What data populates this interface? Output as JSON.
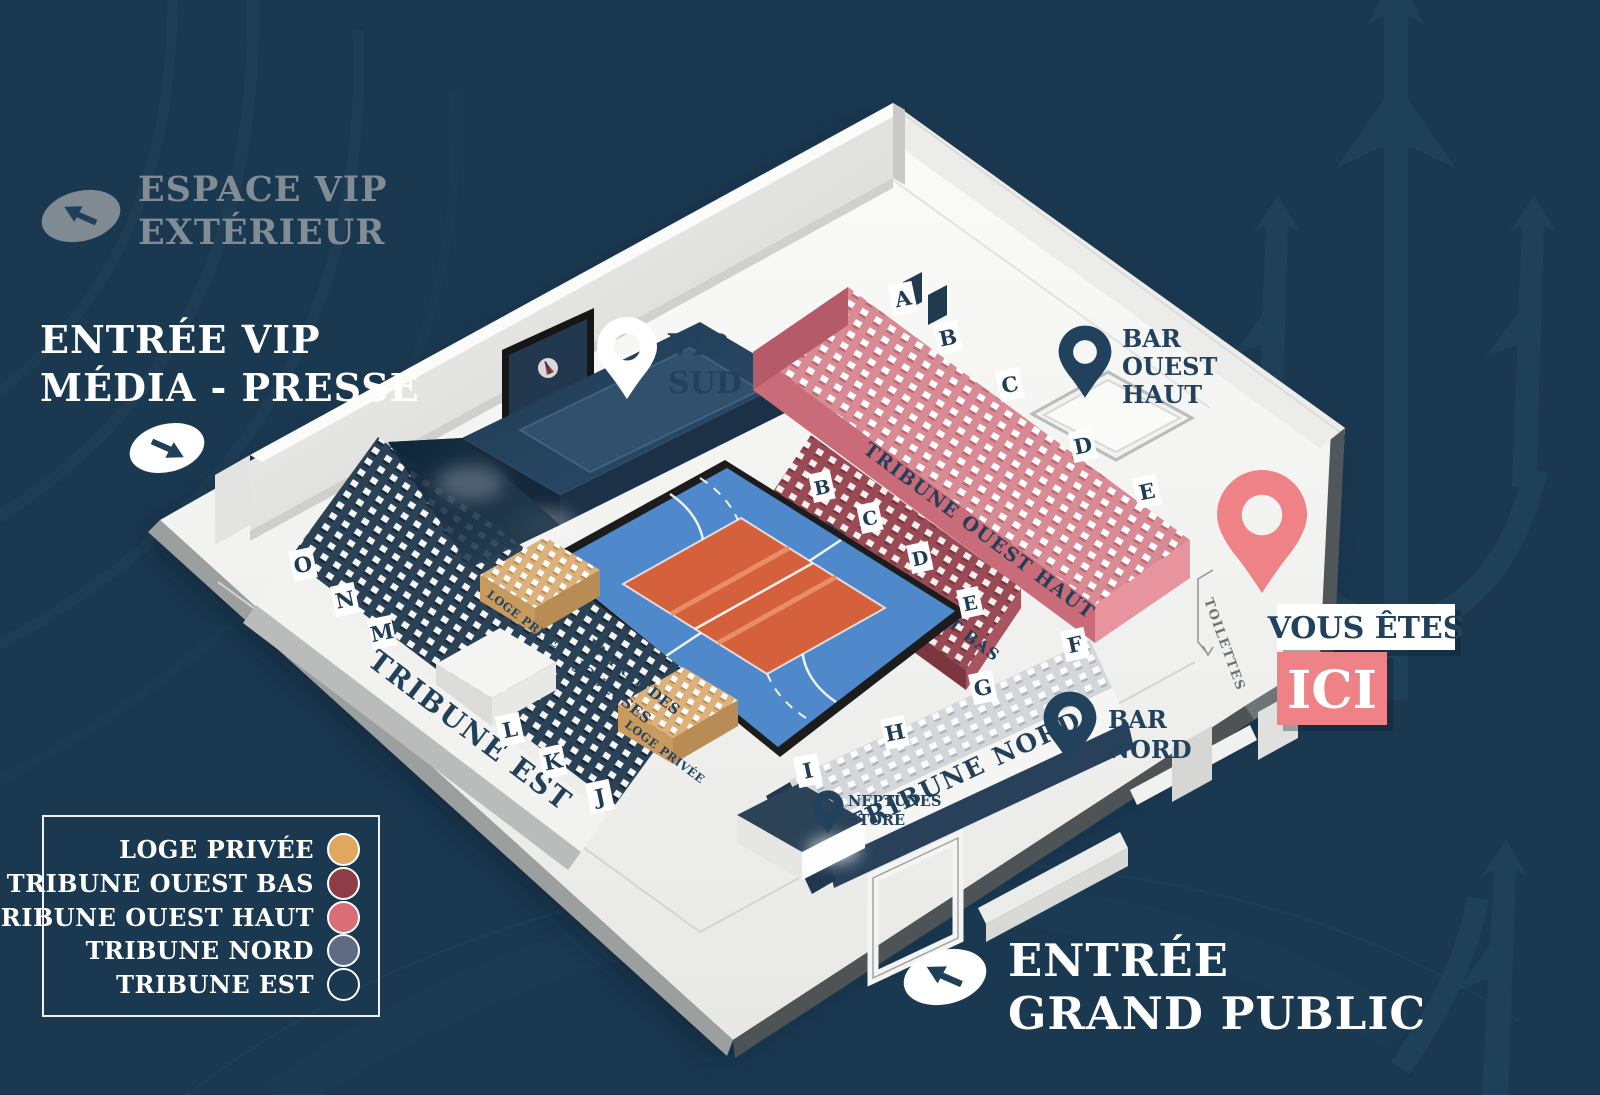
{
  "colors": {
    "background": "#1a3850",
    "accent_pink": "#ef8286",
    "navy": "#22415c",
    "loge_privee": "#e0a75e",
    "tribune_ouest_bas": "#8e3d47",
    "tribune_ouest_haut": "#d96d78",
    "tribune_nord": "#5f6b83",
    "tribune_est": "transparent"
  },
  "outside": {
    "espace_vip": {
      "line1": "ESPACE VIP",
      "line2": "EXTÉRIEUR",
      "arrow": "up-left"
    },
    "entree_vip": {
      "line1": "ENTRÉE VIP",
      "line2": "MÉDIA - PRESSE",
      "arrow": "down-right"
    },
    "entree_grand_public": {
      "line1": "ENTRÉE",
      "line2": "GRAND PUBLIC",
      "arrow": "up-left"
    }
  },
  "pins": {
    "vip_sud": {
      "line1": "VIP",
      "line2": "SUD"
    },
    "bar_ouest_haut": {
      "line1": "BAR",
      "line2": "OUEST",
      "line3": "HAUT"
    },
    "bar_nord": {
      "line1": "BAR",
      "line2": "NORD"
    },
    "neptunes_store": {
      "line1": "NEPTUNES",
      "line2": "STORE"
    },
    "vous_etes": {
      "line1": "VOUS ÊTES",
      "line2": "ICI"
    }
  },
  "tribunes": {
    "ouest_haut": "TRIBUNE OUEST HAUT",
    "ouest_bas": "TRIBUNE OUEST BAS",
    "nord": "TRIBUNE NORD",
    "est": "TRIBUNE EST"
  },
  "map": {
    "loge1": "LOGE PRIVÉE",
    "loge2": "LOGE PRIVÉE",
    "entree_joueuses_l1": "ENTRÉE DES",
    "entree_joueuses_l2": "JOUEUSES",
    "toilettes": "TOILETTES"
  },
  "sections": {
    "ouest_haut": [
      "A",
      "B",
      "C",
      "D",
      "E"
    ],
    "ouest_bas": [
      "B",
      "C",
      "D",
      "E"
    ],
    "nord": [
      "F",
      "G",
      "H",
      "I"
    ],
    "est": [
      "O",
      "N",
      "M",
      "L",
      "K",
      "J"
    ]
  },
  "legend": {
    "items": [
      {
        "label": "LOGE PRIVÉE",
        "color": "#e0a75e",
        "filled": true
      },
      {
        "label": "TRIBUNE OUEST BAS",
        "color": "#8e3d47",
        "filled": true
      },
      {
        "label": "TRIBUNE OUEST HAUT",
        "color": "#d96d78",
        "filled": true
      },
      {
        "label": "TRIBUNE NORD",
        "color": "#5f6b83",
        "filled": true
      },
      {
        "label": "TRIBUNE EST",
        "color": "transparent",
        "filled": false
      }
    ]
  }
}
